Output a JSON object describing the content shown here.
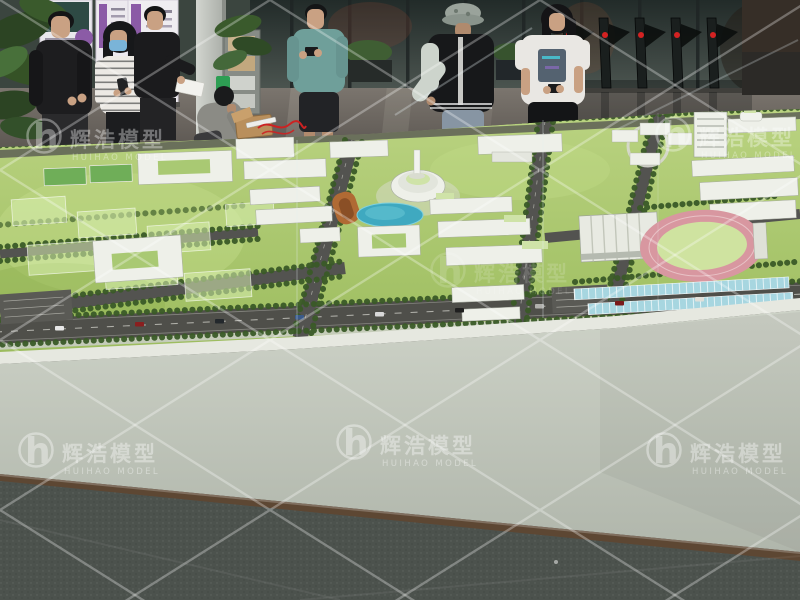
{
  "scene": {
    "type": "photograph",
    "title": "Campus master-plan scale model exhibition",
    "description": "Visitors in a building lobby view a large architectural scale model of a university campus displayed on a white table with a protective glass screen"
  },
  "watermark": {
    "logo_glyph": "h",
    "brand_cn": "辉浩模型",
    "brand_en": "HUIHAO MODEL"
  },
  "palette": {
    "lawn": "#a8c468",
    "tree": "#3a5a28",
    "road": "#53534e",
    "building": "#eef0e9",
    "roof_green": "#cfe3a8",
    "pond": "#3fa9c0",
    "track": "#d897a0",
    "infield": "#cfe3a0",
    "orange_pavilion": "#b06a34",
    "water_panels": "#a7d6e0",
    "table_base": "#c3c9bd",
    "wood_trim": "#5d4733",
    "floor_front": "#4c524d",
    "floor_lobby": "#6b655f",
    "wall_glass": "#36403c",
    "turnstile": "#1a1f1e",
    "turnstile_light": "#d42222",
    "banner_purple": "#8b5ba6",
    "skin": "#c9a183",
    "mask_blue": "#7ab4d8",
    "teal_shirt": "#6f9f9a",
    "jacket_black": "#17181a",
    "sleeve_grey": "#cdd4cc",
    "jeans": "#8795a3",
    "watermark_white": "#ffffff"
  },
  "people": [
    {
      "id": "man-black-tshirt",
      "description": "Middle-aged man in black t-shirt standing at far left"
    },
    {
      "id": "woman-face-mask",
      "description": "Woman with long dark hair, light blue face mask and striped top, looking at her phone"
    },
    {
      "id": "man-with-flyer",
      "description": "Man in dark shirt holding a white flyer"
    },
    {
      "id": "technician",
      "description": "Technician in grey shirt crouched over the model edge with a cardboard box and red wires"
    },
    {
      "id": "man-teal-tshirt",
      "description": "Man in teal t-shirt and cropped black trousers checking his phone"
    },
    {
      "id": "person-bucket-hat",
      "description": "Visitor in camo bucket hat and black varsity jacket pointing at the model"
    },
    {
      "id": "woman-white-tshirt",
      "description": "Young woman in white graphic t-shirt and black skirt studying the model"
    }
  ],
  "model": {
    "description": "White-and-green campus master plan model: lawns, tree-lined roads, white mid-rise buildings, central round hall with monument, pond, orange pavilion, gymnasium, pink running track, dormitory rows, solar/water strips, parking lots and translucent future-phase blocks",
    "landmarks": [
      "central round hall",
      "monument tower",
      "pond",
      "orange pavilion",
      "gymnasium",
      "running track",
      "dormitory rows",
      "solar water strips",
      "parking lots",
      "future phase blocks",
      "sports courts"
    ]
  },
  "background": {
    "items": [
      "roll-up banners",
      "potted plants",
      "brochure rack",
      "lobby column",
      "glass entrance wall",
      "turnstile security gates",
      "glossy stone floor"
    ]
  }
}
